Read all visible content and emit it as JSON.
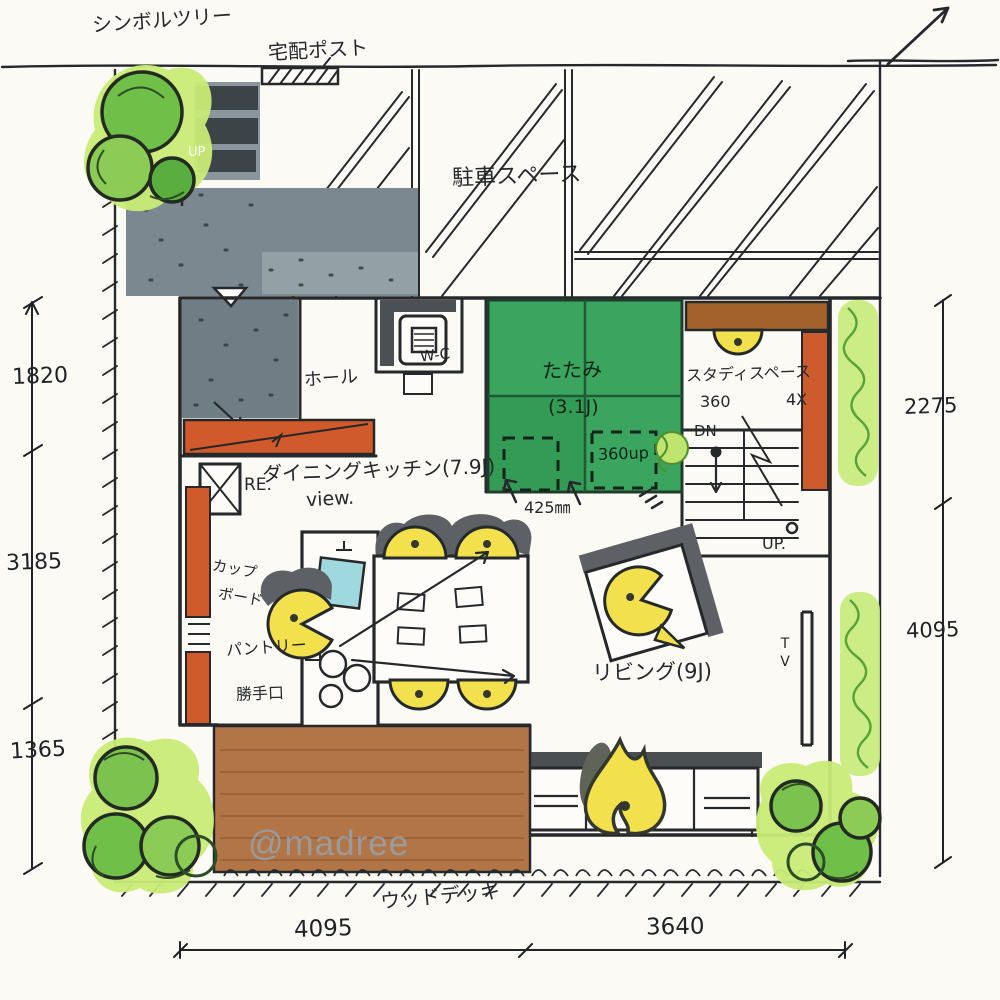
{
  "watermark": "@madree",
  "site": {
    "labels": {
      "symbol_tree": "シンボルツリー",
      "delivery_post": "宅配ポスト",
      "parking": "駐車スペース",
      "wood_deck": "ウッドデッキ"
    }
  },
  "rooms": {
    "entrance": {
      "up": "UP",
      "hall": "ホール"
    },
    "toilet": {
      "label": "W-C"
    },
    "tatami": {
      "name": "たたみ",
      "size": "(3.1J)",
      "raised": "360up"
    },
    "study": {
      "name": "スタディスペース",
      "height": "360",
      "size": "4X",
      "down": "DN"
    },
    "stairs": {
      "up": "UP."
    },
    "dining_kitchen": {
      "name": "ダイニングキッチン(7.9J)",
      "view": "view.",
      "fridge": "RE.",
      "step": "425㎜",
      "cupboard_line1": "カップ",
      "cupboard_line2": "ボード",
      "pantry": "パントリー",
      "back_door": "勝手口"
    },
    "living": {
      "name": "リビング(9J)",
      "tv": "TV"
    }
  },
  "dimensions": {
    "left": [
      "1820",
      "3185",
      "1365"
    ],
    "right": [
      "2275",
      "4095"
    ],
    "bottom": [
      "4095",
      "3640"
    ]
  },
  "colors": {
    "paper": "#fbfaf5",
    "ink": "#26292c",
    "tatami_green": "#3ba45e",
    "tree_green": "#6fbf49",
    "tree_glow": "#c9ec77",
    "deck_brown": "#b27547",
    "desk_brown": "#a3622c",
    "accent_orange": "#d15a2c",
    "furniture_yellow": "#f2e14c",
    "concrete_gray": "#7b8890",
    "shadow_gray": "#5d6165",
    "sink_cyan": "#9fd8de",
    "watermark_gray": "#96a5b3"
  }
}
